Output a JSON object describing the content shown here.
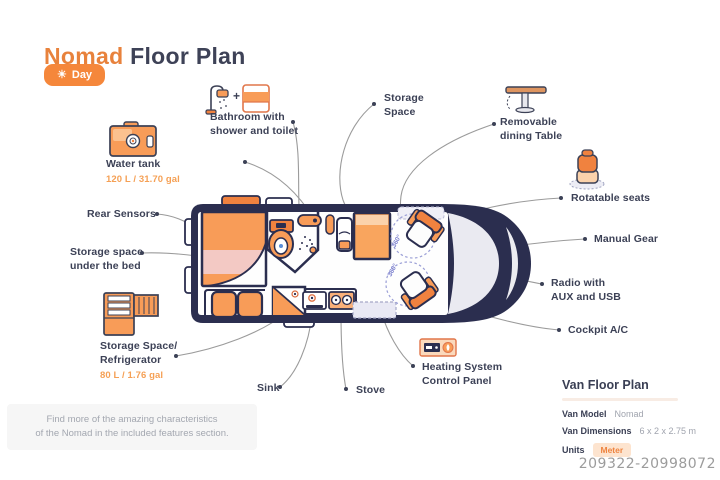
{
  "header": {
    "title_accent": "Nomad",
    "title_rest": " Floor Plan",
    "mode_button": {
      "icon": "sun-icon",
      "label": "Day"
    }
  },
  "callouts": {
    "bathroom": {
      "line1": "Bathroom with",
      "line2": "shower and toilet"
    },
    "storage_space": {
      "line1": "Storage",
      "line2": "Space"
    },
    "dining_table": {
      "line1": "Removable",
      "line2": "dining Table"
    },
    "rotatable_seats": {
      "label": "Rotatable seats"
    },
    "manual_gear": {
      "label": "Manual Gear"
    },
    "radio": {
      "line1": "Radio with",
      "line2": "AUX and USB"
    },
    "cockpit_ac": {
      "label": "Cockpit A/C"
    },
    "water_tank": {
      "label": "Water tank",
      "capacity": "120 L / 31.70 gal"
    },
    "rear_sensors": {
      "label": "Rear Sensors"
    },
    "under_bed": {
      "line1": "Storage space",
      "line2": "under the bed"
    },
    "refrigerator": {
      "line1": "Storage Space/",
      "line2": "Refrigerator",
      "capacity": "80 L / 1.76 gal"
    },
    "sink": {
      "label": "Sink"
    },
    "stove": {
      "label": "Stove"
    },
    "heating": {
      "line1": "Heating System",
      "line2": "Control Panel"
    }
  },
  "diagram": {
    "swivel_front": "360°",
    "swivel_rear": "360°",
    "plus_sign": "+"
  },
  "footnote": {
    "line1": "Find more of the amazing characteristics",
    "line2": "of the Nomad in the included features section."
  },
  "spec_panel": {
    "title": "Van Floor Plan",
    "rows": [
      {
        "label": "Van Model",
        "value": "Nomad"
      },
      {
        "label": "Van Dimensions",
        "value": "6 x 2 x 2.75 m"
      },
      {
        "label": "Units",
        "value": "Meter"
      }
    ]
  },
  "watermark": "209322-20998072",
  "colors": {
    "accent_orange": "#EE8440",
    "fill_orange": "#F89C58",
    "light_orange": "#FBD2AB",
    "navy": "#2B2E4F",
    "bed_pink": "#F3C9C4",
    "label_text": "#3C4156",
    "muted_text": "#A0A4AE"
  }
}
